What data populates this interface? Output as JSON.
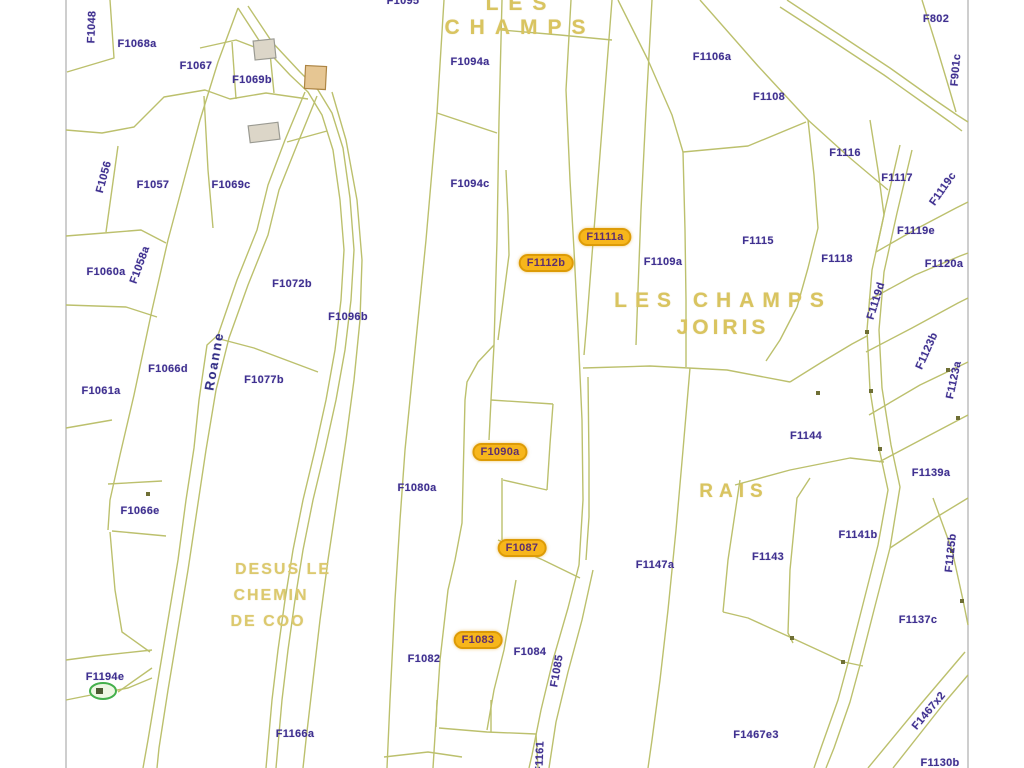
{
  "colors": {
    "parcel_line": "#bcc06d",
    "map_border": "#b3b3b3",
    "parcel_label": "#3f3090",
    "place_label": "#d9c460",
    "highlight_bg": "#f7b61b",
    "highlight_border": "#dd9b06",
    "stream_label": "#332f86",
    "building_fill": "#dcd6c8",
    "building_accent": "#e6c693",
    "pond_marker": "#44b04c"
  },
  "labels": [
    {
      "text": "F1095",
      "x": 403,
      "y": 1,
      "rot": 0,
      "kind": "parcel"
    },
    {
      "text": "LES",
      "x": 521,
      "y": 4,
      "rot": 0,
      "kind": "place-top"
    },
    {
      "text": "CHAMPS",
      "x": 520,
      "y": 28,
      "rot": 0,
      "kind": "place-top"
    },
    {
      "text": "F1048",
      "x": 92,
      "y": 27,
      "rot": -88,
      "kind": "parcel"
    },
    {
      "text": "F1068a",
      "x": 137,
      "y": 44,
      "rot": 0,
      "kind": "parcel"
    },
    {
      "text": "F1067",
      "x": 196,
      "y": 66,
      "rot": 0,
      "kind": "parcel"
    },
    {
      "text": "F1069b",
      "x": 252,
      "y": 80,
      "rot": 0,
      "kind": "parcel"
    },
    {
      "text": "F1094a",
      "x": 470,
      "y": 62,
      "rot": 0,
      "kind": "parcel"
    },
    {
      "text": "F1106a",
      "x": 712,
      "y": 57,
      "rot": 0,
      "kind": "parcel"
    },
    {
      "text": "F802",
      "x": 936,
      "y": 19,
      "rot": 0,
      "kind": "parcel"
    },
    {
      "text": "F901c",
      "x": 956,
      "y": 70,
      "rot": -85,
      "kind": "parcel"
    },
    {
      "text": "F1108",
      "x": 769,
      "y": 97,
      "rot": 0,
      "kind": "parcel"
    },
    {
      "text": "F1116",
      "x": 845,
      "y": 153,
      "rot": 0,
      "kind": "parcel"
    },
    {
      "text": "F1117",
      "x": 897,
      "y": 178,
      "rot": 0,
      "kind": "parcel"
    },
    {
      "text": "F1119c",
      "x": 943,
      "y": 189,
      "rot": -55,
      "kind": "parcel"
    },
    {
      "text": "F1056",
      "x": 104,
      "y": 177,
      "rot": -75,
      "kind": "parcel"
    },
    {
      "text": "F1057",
      "x": 153,
      "y": 185,
      "rot": 0,
      "kind": "parcel"
    },
    {
      "text": "F1069c",
      "x": 231,
      "y": 185,
      "rot": 0,
      "kind": "parcel"
    },
    {
      "text": "F1094c",
      "x": 470,
      "y": 184,
      "rot": 0,
      "kind": "parcel"
    },
    {
      "text": "F1119e",
      "x": 916,
      "y": 231,
      "rot": 0,
      "kind": "parcel"
    },
    {
      "text": "F1111a",
      "x": 605,
      "y": 237,
      "rot": 0,
      "kind": "highlight"
    },
    {
      "text": "F1115",
      "x": 758,
      "y": 241,
      "rot": 0,
      "kind": "parcel"
    },
    {
      "text": "F1118",
      "x": 837,
      "y": 259,
      "rot": 0,
      "kind": "parcel"
    },
    {
      "text": "F1120a",
      "x": 944,
      "y": 264,
      "rot": 0,
      "kind": "parcel"
    },
    {
      "text": "F1112b",
      "x": 546,
      "y": 263,
      "rot": 0,
      "kind": "highlight"
    },
    {
      "text": "F1109a",
      "x": 663,
      "y": 262,
      "rot": 0,
      "kind": "parcel"
    },
    {
      "text": "F1058a",
      "x": 140,
      "y": 265,
      "rot": -70,
      "kind": "parcel"
    },
    {
      "text": "F1060a",
      "x": 106,
      "y": 272,
      "rot": 0,
      "kind": "parcel"
    },
    {
      "text": "F1072b",
      "x": 292,
      "y": 284,
      "rot": 0,
      "kind": "parcel"
    },
    {
      "text": "F1119d",
      "x": 876,
      "y": 301,
      "rot": -73,
      "kind": "parcel"
    },
    {
      "text": "LES CHAMPS",
      "x": 723,
      "y": 301,
      "rot": 0,
      "kind": "place-lg"
    },
    {
      "text": "JOIRIS",
      "x": 723,
      "y": 328,
      "rot": 0,
      "kind": "place-md"
    },
    {
      "text": "F1096b",
      "x": 348,
      "y": 317,
      "rot": 0,
      "kind": "parcel"
    },
    {
      "text": "F1123b",
      "x": 927,
      "y": 351,
      "rot": -66,
      "kind": "parcel"
    },
    {
      "text": "Roanne",
      "x": 214,
      "y": 361,
      "rot": -80,
      "kind": "stream"
    },
    {
      "text": "F1066d",
      "x": 168,
      "y": 369,
      "rot": 0,
      "kind": "parcel"
    },
    {
      "text": "F1077b",
      "x": 264,
      "y": 380,
      "rot": 0,
      "kind": "parcel"
    },
    {
      "text": "F1061a",
      "x": 101,
      "y": 391,
      "rot": 0,
      "kind": "parcel"
    },
    {
      "text": "F1123a",
      "x": 954,
      "y": 380,
      "rot": -78,
      "kind": "parcel"
    },
    {
      "text": "F1144",
      "x": 806,
      "y": 436,
      "rot": 0,
      "kind": "parcel"
    },
    {
      "text": "F1090a",
      "x": 500,
      "y": 452,
      "rot": 0,
      "kind": "highlight"
    },
    {
      "text": "F1139a",
      "x": 931,
      "y": 473,
      "rot": 0,
      "kind": "parcel"
    },
    {
      "text": "F1080a",
      "x": 417,
      "y": 488,
      "rot": 0,
      "kind": "parcel"
    },
    {
      "text": "RAIS",
      "x": 734,
      "y": 492,
      "rot": 0,
      "kind": "place-rais"
    },
    {
      "text": "F1066e",
      "x": 140,
      "y": 511,
      "rot": 0,
      "kind": "parcel"
    },
    {
      "text": "F1141b",
      "x": 858,
      "y": 535,
      "rot": 0,
      "kind": "parcel"
    },
    {
      "text": "F1143",
      "x": 768,
      "y": 557,
      "rot": 0,
      "kind": "parcel"
    },
    {
      "text": "F1125b",
      "x": 951,
      "y": 553,
      "rot": -84,
      "kind": "parcel"
    },
    {
      "text": "F1087",
      "x": 522,
      "y": 548,
      "rot": 0,
      "kind": "highlight"
    },
    {
      "text": "F1147a",
      "x": 655,
      "y": 565,
      "rot": 0,
      "kind": "parcel"
    },
    {
      "text": "DESUS LE",
      "x": 283,
      "y": 570,
      "rot": 0,
      "kind": "place-desus"
    },
    {
      "text": "CHEMIN",
      "x": 271,
      "y": 596,
      "rot": 0,
      "kind": "place-desus"
    },
    {
      "text": "DE COO",
      "x": 268,
      "y": 622,
      "rot": 0,
      "kind": "place-desus"
    },
    {
      "text": "F1137c",
      "x": 918,
      "y": 620,
      "rot": 0,
      "kind": "parcel"
    },
    {
      "text": "F1083",
      "x": 478,
      "y": 640,
      "rot": 0,
      "kind": "highlight"
    },
    {
      "text": "F1082",
      "x": 424,
      "y": 659,
      "rot": 0,
      "kind": "parcel"
    },
    {
      "text": "F1084",
      "x": 530,
      "y": 652,
      "rot": 0,
      "kind": "parcel"
    },
    {
      "text": "F1085",
      "x": 557,
      "y": 671,
      "rot": -80,
      "kind": "parcel"
    },
    {
      "text": "F1194e",
      "x": 105,
      "y": 677,
      "rot": 0,
      "kind": "parcel"
    },
    {
      "text": "F1467x2",
      "x": 929,
      "y": 711,
      "rot": -50,
      "kind": "parcel"
    },
    {
      "text": "F1166a",
      "x": 295,
      "y": 734,
      "rot": 0,
      "kind": "parcel"
    },
    {
      "text": "F1467e3",
      "x": 756,
      "y": 735,
      "rot": 0,
      "kind": "parcel"
    },
    {
      "text": "F1130b",
      "x": 940,
      "y": 763,
      "rot": 0,
      "kind": "parcel"
    },
    {
      "text": "F1161",
      "x": 540,
      "y": 757,
      "rot": -88,
      "kind": "parcel"
    }
  ]
}
